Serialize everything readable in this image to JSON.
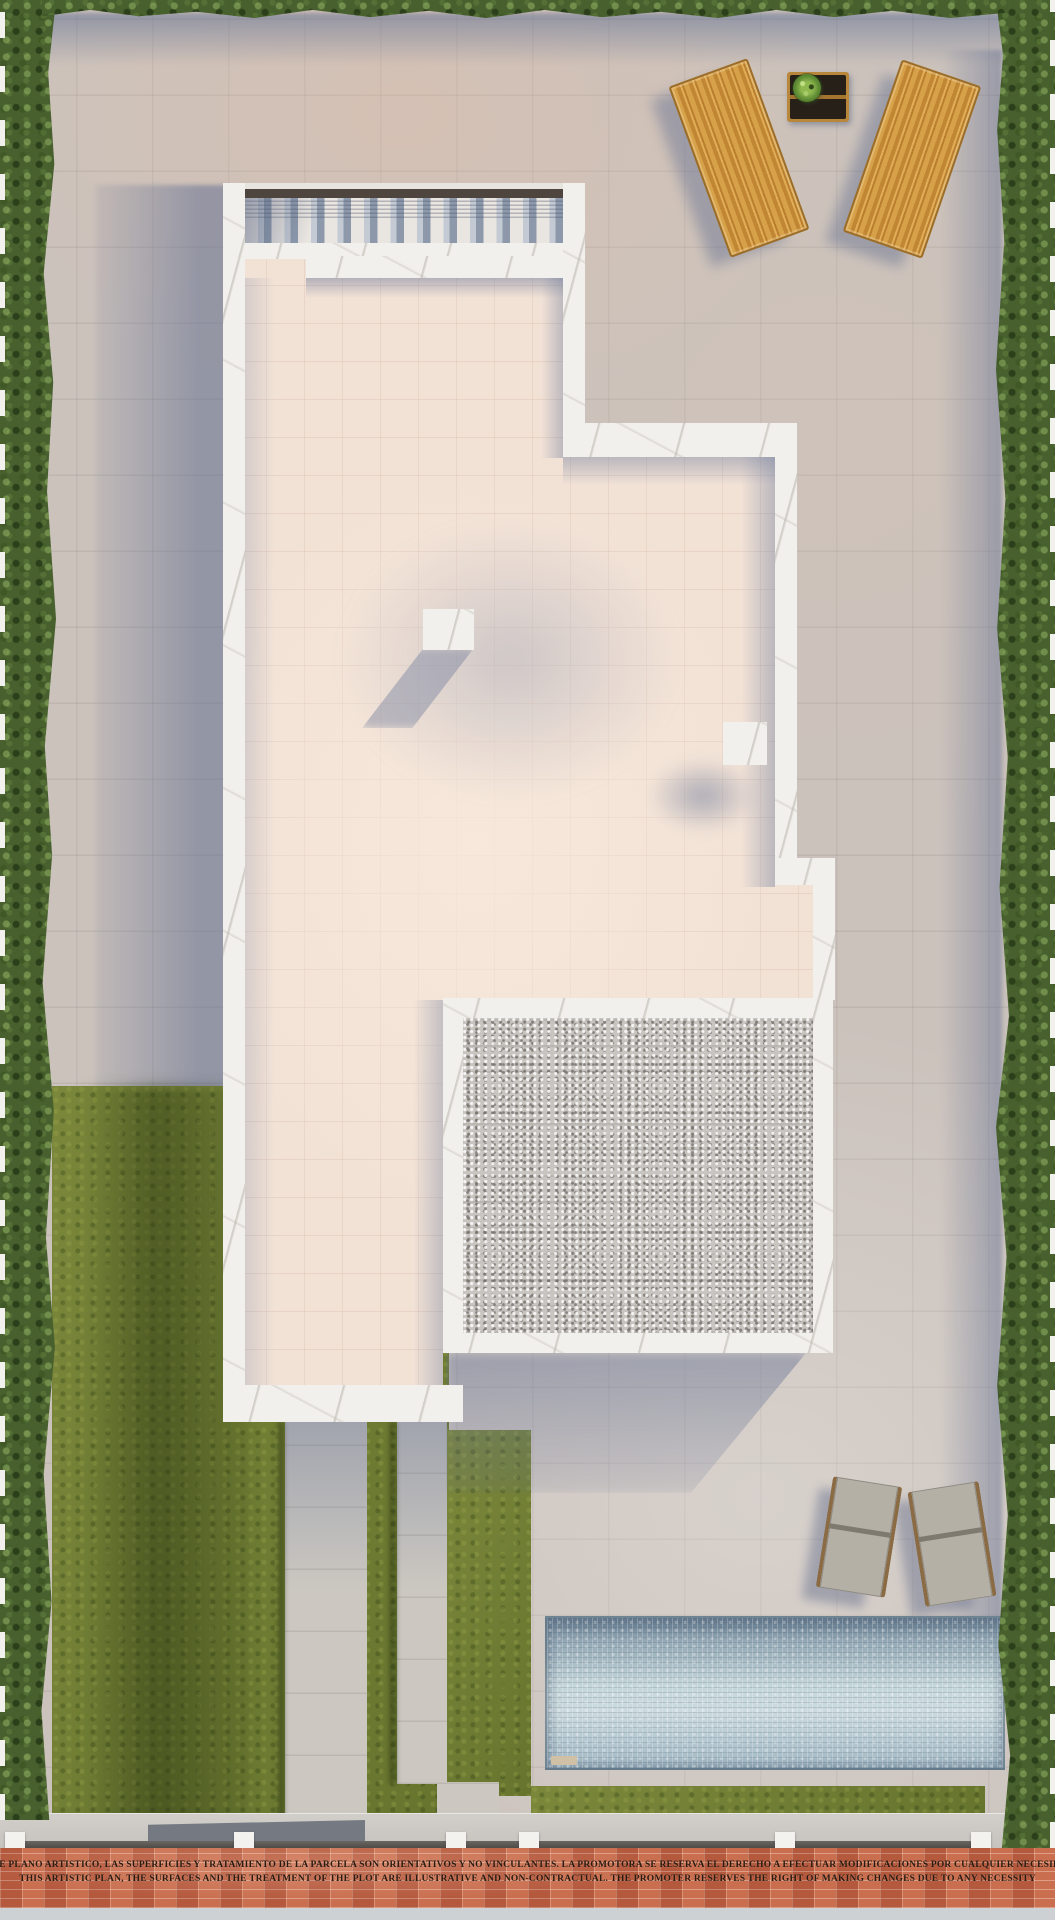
{
  "document": {
    "kind": "architectural-site-plan-render",
    "view": "top-down"
  },
  "disclaimer": {
    "line_es": "ESTE PLANO ARTISTICO, LAS SUPERFICIES Y TRATAMIENTO DE LA PARCELA SON ORIENTATIVOS Y NO VINCULANTES. LA PROMOTORA SE RESERVA EL DERECHO A EFECTUAR MODIFICACIONES POR CUALQUIER NECESIDAD",
    "line_en": "THIS ARTISTIC PLAN, THE SURFACES AND THE TREATMENT OF THE PLOT ARE ILLUSTRATIVE AND NON-CONTRACTUAL. THE PROMOTER RESERVES THE RIGHT OF MAKING CHANGES DUE TO ANY NECESSITY"
  },
  "palette": {
    "paving_warm": "#cbc2bc",
    "paving_shadow_blue": "#97a0b4",
    "roof_deck_pink": "#f2e2d6",
    "wall_white": "#f2f0ec",
    "hedge_green": "#47602e",
    "grass_olive": "#6f7d33",
    "gravel_gray": "#c8c5c1",
    "pool_water_light": "#c5d6da",
    "pool_water_deep": "#8ba1af",
    "wood_lounger": "#c98f3c",
    "brick_sidewalk": "#c2684a",
    "text_color": "#2b1a10"
  },
  "scene": {
    "features": [
      "perimeter-hedges-left-right-top",
      "white-villa-roof-plan-with-stairs",
      "pink-roof-terrace",
      "gravel-roof-square",
      "two-wooden-sun-loungers-with-side-table-and-plant",
      "two-gray-sun-loungers-by-pool",
      "rectangular-swimming-pool",
      "lawn-areas-with-concrete-walkways",
      "brick-sidewalk-with-disclaimer-text",
      "entrance-gates-and-fence-posts"
    ]
  }
}
